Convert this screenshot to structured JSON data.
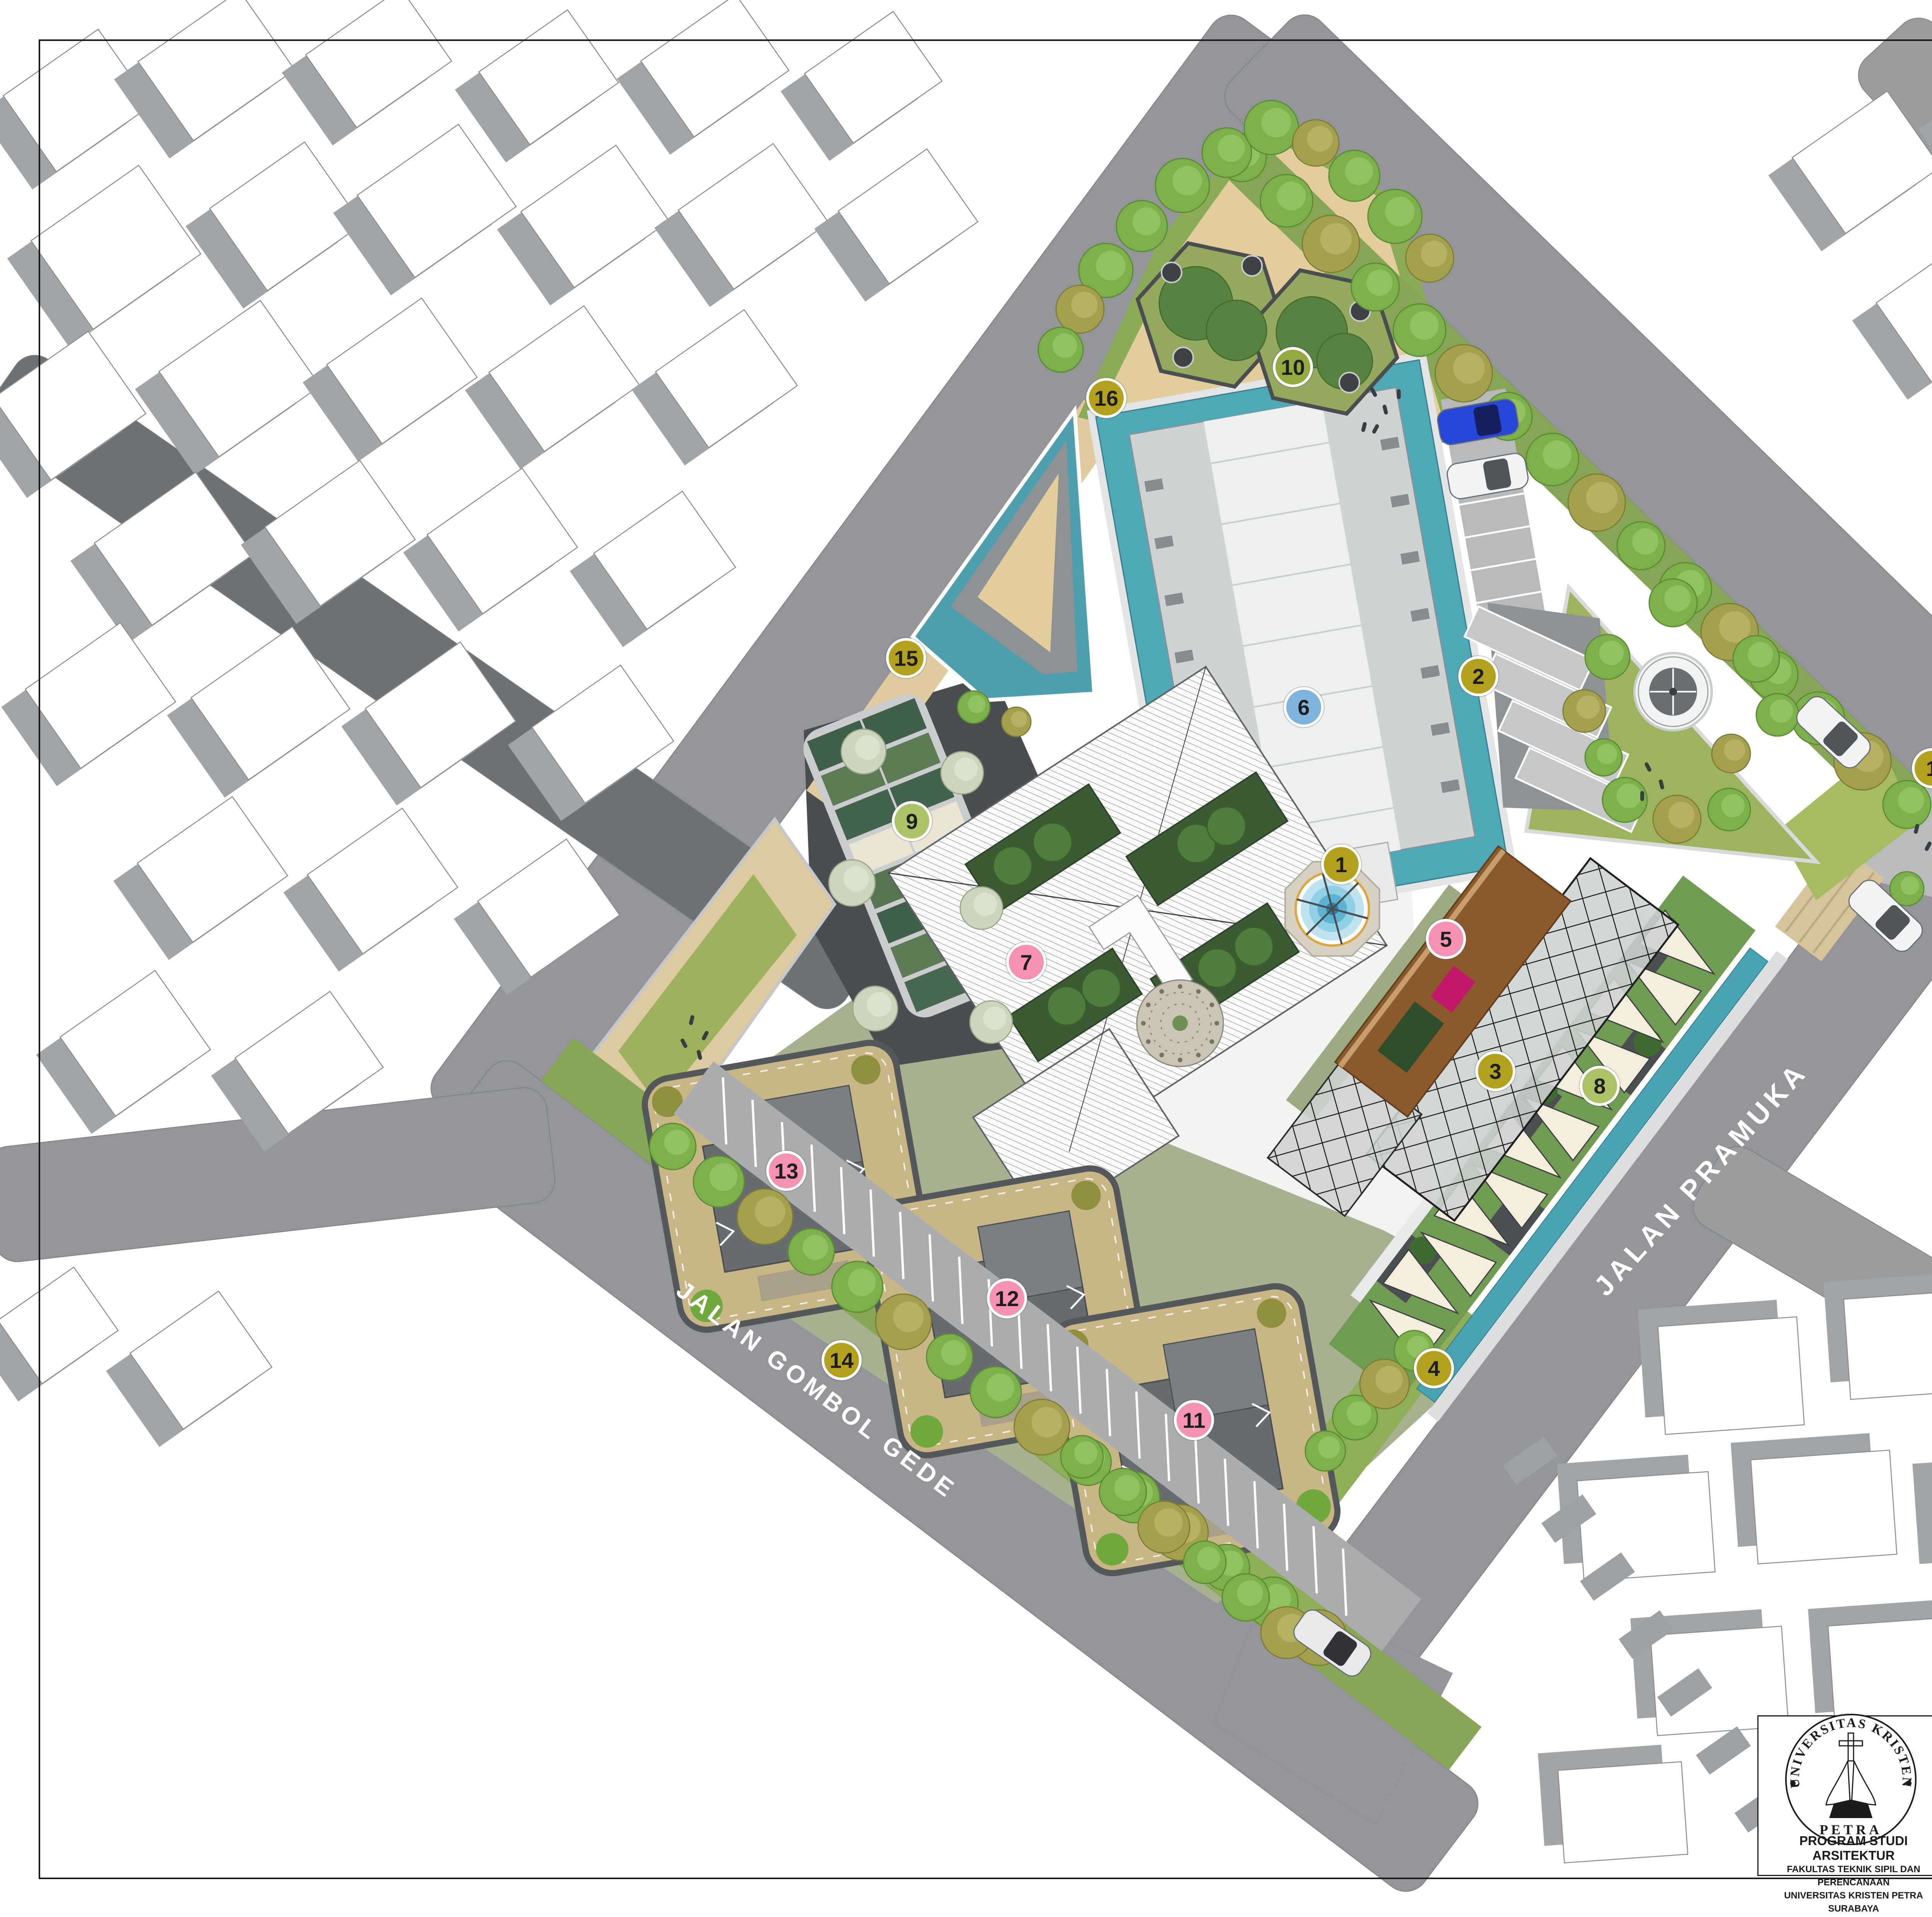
{
  "sheet": {
    "background": "#ffffff",
    "frame_color": "#1a1a1a"
  },
  "streets": {
    "gombol": "JALAN GOMBOL GEDE",
    "pramuka": "JALAN PRAMUKA"
  },
  "legend": {
    "title": "LEGENDA :",
    "items": [
      {
        "no": "1.",
        "label": "AKSES MASUK"
      },
      {
        "no": "2.",
        "label": "PARKIR PENGUNJUNG"
      },
      {
        "no": "3.",
        "label": "JALUR DROP OFF"
      },
      {
        "no": "4.",
        "label": "AKSES KELUAR"
      },
      {
        "no": "5.",
        "label": "MASSA PENERIMA"
      },
      {
        "no": "6.",
        "label": "MASSA IBADAH"
      },
      {
        "no": "7.",
        "label": "MASSA PENDUKUNG"
      },
      {
        "no": "8.",
        "label": "WALKING PLAZA"
      },
      {
        "no": "9.",
        "label": "ROOF PLAZA"
      },
      {
        "no": "10.",
        "label": "TREE PATIO"
      },
      {
        "no": "11.",
        "label": "MASSA HUNIAN"
      },
      {
        "no": "12.",
        "label": "MASSA HUNIAN"
      },
      {
        "no": "13.",
        "label": "MASSA HUNIAN"
      },
      {
        "no": "14.",
        "label": "PARKIR PENGINAP"
      },
      {
        "no": "15.",
        "label": "AKSES MASUK SERVIS"
      },
      {
        "no": "16.",
        "label": "AKSES KELUAR SERVIS"
      }
    ]
  },
  "site_label": {
    "title": "SITE PLAN",
    "scale": "SKALA 1:500"
  },
  "markers": {
    "types": {
      "access": "#b3a01d",
      "mass": "#f591b4",
      "ibadah": "#7fb3dc",
      "plaza": "#a9c366",
      "patio": "#94a93f"
    },
    "items": [
      {
        "n": "1",
        "t": "access"
      },
      {
        "n": "1",
        "t": "access"
      },
      {
        "n": "2",
        "t": "access"
      },
      {
        "n": "3",
        "t": "access"
      },
      {
        "n": "4",
        "t": "access"
      },
      {
        "n": "5",
        "t": "mass"
      },
      {
        "n": "6",
        "t": "ibadah"
      },
      {
        "n": "7",
        "t": "mass"
      },
      {
        "n": "8",
        "t": "plaza"
      },
      {
        "n": "9",
        "t": "plaza"
      },
      {
        "n": "10",
        "t": "patio"
      },
      {
        "n": "11",
        "t": "mass"
      },
      {
        "n": "12",
        "t": "mass"
      },
      {
        "n": "13",
        "t": "mass"
      },
      {
        "n": "14",
        "t": "access"
      },
      {
        "n": "15",
        "t": "access"
      },
      {
        "n": "16",
        "t": "access"
      }
    ]
  },
  "title_block": {
    "header": "TUGAS AKHIR - SEMESTER GENAP 2023/2024",
    "labels": {
      "judul_tugas": "JUDUL TUGAS",
      "judul_gambar": "JUDUL GAMBAR",
      "skala": "SKALA",
      "nama": "NAMA",
      "nrp": "NRP",
      "kelompok": "KELOMPOK",
      "mentor_utama": "MENTOR UTAMA",
      "mentor_pendamping": "MENTOR PENDAMPING",
      "pengesahan": "PENGESAHAN",
      "lembar": "LEMBAR",
      "jumlah": "JUMLAH",
      "tanggal": "TANGGAL"
    },
    "values": {
      "judul_tugas": "FASILITAS RETREAT DI CIREBON",
      "judul_gambar": "SITE PLAN",
      "skala": "1:500",
      "nama": "LEONARDO MATTHEW S.",
      "nrp": "B12190044",
      "kelompok": "7",
      "mentor_utama": "Ir. Samuel Hartono, M.Sc.",
      "mentor_pendamping_1": "Altrerosje, S.T., M.T.",
      "mentor_pendamping_2": "Elvina S. Wijaya, S.T., M.T."
    },
    "org": {
      "line1": "PROGRAM STUDI ARSITEKTUR",
      "line2": "FAKULTAS TEKNIK SIPIL DAN PERENCANAAN",
      "line3": "UNIVERSITAS KRISTEN PETRA",
      "line4": "SURABAYA"
    },
    "logo": {
      "top": "UNIVERSITAS KRISTEN",
      "bottom": "PETRA"
    }
  }
}
